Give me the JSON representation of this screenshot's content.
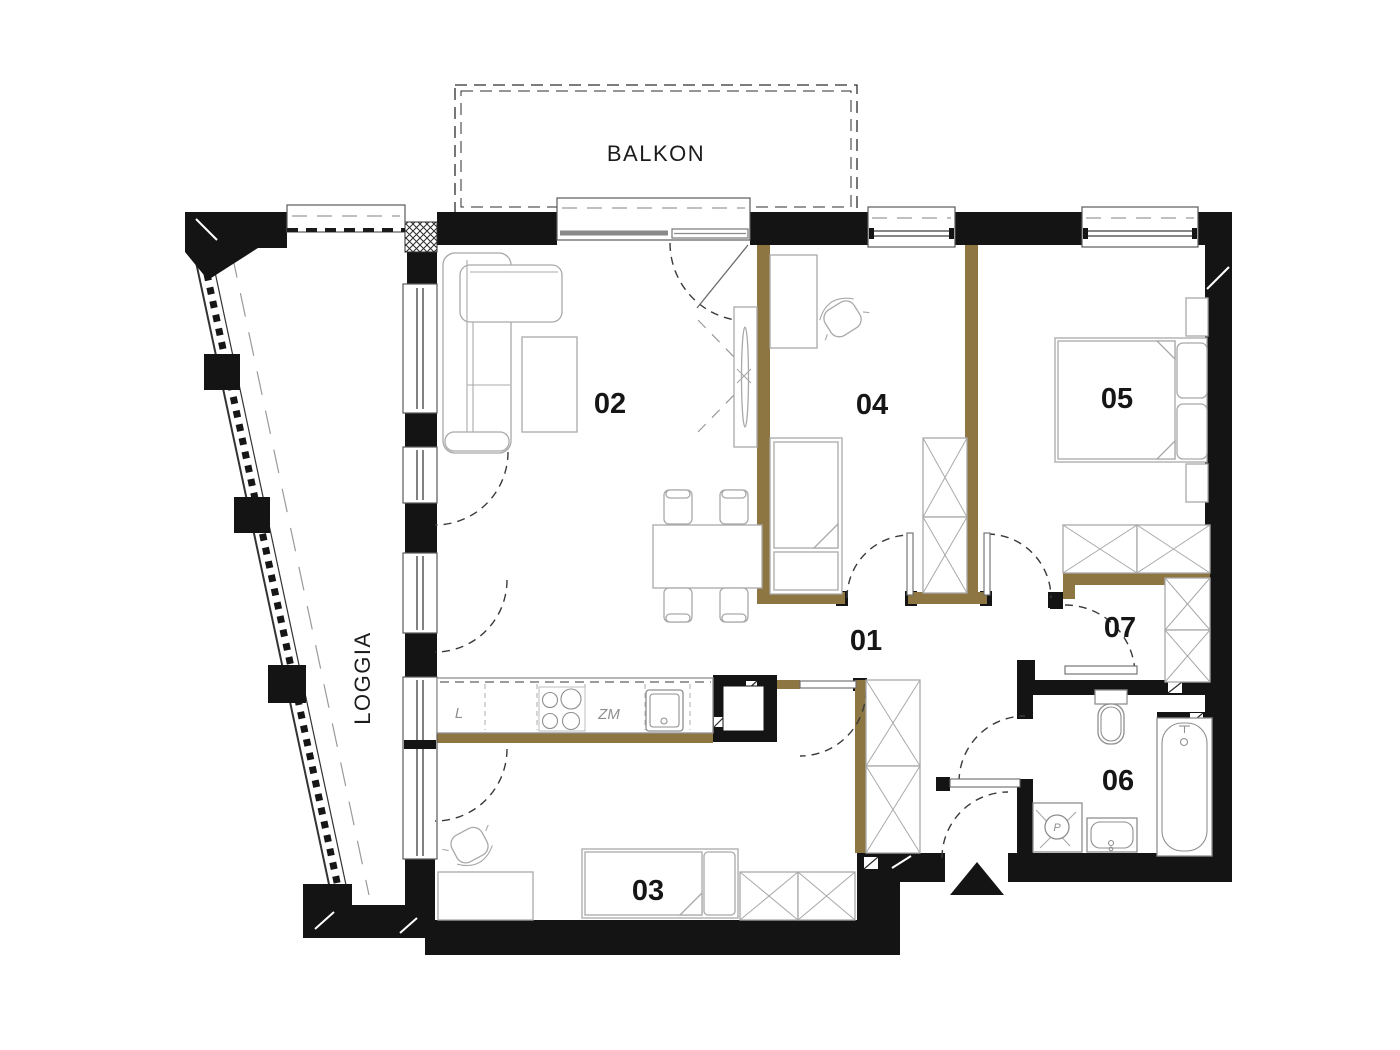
{
  "plan": {
    "labels": {
      "balcony": "BALKON",
      "loggia": "LOGGIA"
    },
    "rooms": [
      {
        "number": "01"
      },
      {
        "number": "02"
      },
      {
        "number": "03"
      },
      {
        "number": "04"
      },
      {
        "number": "05"
      },
      {
        "number": "06"
      },
      {
        "number": "07"
      }
    ],
    "kitchen": {
      "fridge": "L",
      "dishwasher": "ZM"
    },
    "bathroom": {
      "washer": "P"
    },
    "colors": {
      "background": "#ffffff",
      "wall": "#141414",
      "partition_accent": "#8d7642",
      "furniture_outline": "#a9a9a9",
      "door_swing": "#3a3a3a"
    }
  }
}
